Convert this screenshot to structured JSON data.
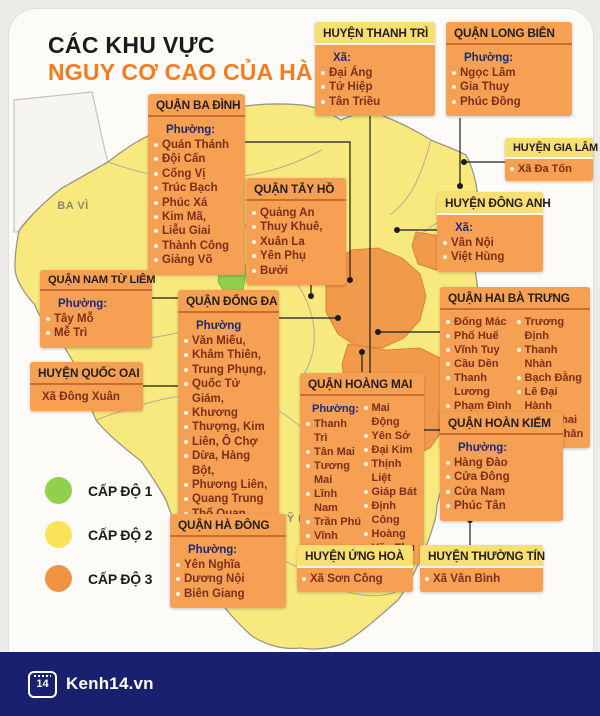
{
  "title": {
    "line1": "CÁC KHU VỰC",
    "line2": "NGUY CƠ CAO CỦA HÀ NỘI"
  },
  "colors": {
    "accent_orange": "#F47B20",
    "box_orange": "#F5A052",
    "header_yellow": "#F8DF72",
    "level1_green": "#8FD04C",
    "level2_yellow": "#F8E97F",
    "level3_orange": "#F19A4B",
    "footer_navy": "#19206E",
    "label_navy": "#1E2A78"
  },
  "legend": [
    {
      "label": "CẤP ĐỘ 1",
      "color": "#8FD04C"
    },
    {
      "label": "CẤP ĐỘ 2",
      "color": "#F8E456"
    },
    {
      "label": "CẤP ĐỘ 3",
      "color": "#F19442"
    }
  ],
  "map_labels": {
    "ba_vi": "BA VÌ",
    "ung_hoa": "ỨNG HÒA",
    "my_duc": "MỸ ĐỨC"
  },
  "boxes": [
    {
      "title": "HUYỆN THANH TRÌ",
      "label": "Xã:",
      "items": [
        "Đại Áng",
        "Tứ Hiệp",
        "Tân Triều"
      ]
    },
    {
      "title": "QUẬN LONG BIÊN",
      "label": "Phường:",
      "items": [
        "Ngọc Lâm",
        "Gia Thuy",
        "Phúc Đồng"
      ]
    },
    {
      "title": "QUẬN BA ĐÌNH",
      "label": "Phường:",
      "items": [
        "Quán Thánh",
        "Đội Cấn",
        "Cống Vị",
        "Trúc Bạch",
        "Phúc Xá",
        "Kim Mã,",
        "Liễu Giai",
        "Thành Công",
        "Giảng Võ"
      ]
    },
    {
      "title": "QUẬN TÂY HỒ",
      "label": "",
      "items": [
        "Quảng An",
        "Thuy Khuê,",
        "Xuân La",
        "Yên Phụ",
        "Bưởi"
      ]
    },
    {
      "title": "HUYỆN GIA LÂM",
      "label": "",
      "items": [
        "Xã Đa Tốn"
      ]
    },
    {
      "title": "HUYỆN ĐÔNG ANH",
      "label": "Xã:",
      "items": [
        "Vân Nội",
        "Việt Hùng"
      ]
    },
    {
      "title": "QUẬN NAM TỪ LIÊM",
      "label": "Phường:",
      "items": [
        "Tây Mỗ",
        "Mễ Trì"
      ]
    },
    {
      "title": "HUYỆN QUỐC OAI",
      "label": "",
      "items": [
        "Xã Đông Xuân"
      ]
    },
    {
      "title": "QUẬN ĐỐNG ĐA",
      "label": "Phường",
      "items": [
        "Văn Miếu,",
        "Khâm Thiên,",
        "Trung Phụng,",
        "Quốc Tử Giám,",
        "Khương",
        "Thượng, Kim",
        "Liên, Ô Chợ",
        "Dừa, Hàng Bột,",
        "Phương Liên,",
        "Quang Trung",
        "Thổ Quan"
      ]
    },
    {
      "title": "QUẬN HAI BÀ TRƯNG",
      "label": "",
      "items_left": [
        "Đống Mác",
        "Phố Huế",
        "Vĩnh Tuy",
        "Cầu Dền",
        "Thanh Lương",
        "Phạm Đình Hổ"
      ],
      "items_right": [
        "Trương Định",
        "Thanh Nhàn",
        "Bạch Đằng",
        "Lê Đại Hành",
        "Minh Khai",
        "Đồng Nhân"
      ]
    },
    {
      "title": "QUẬN HOÀNG MAI",
      "label": "Phường:",
      "items_left": [
        "Thanh Trì",
        "Tân Mai",
        "Tương Mai",
        "Lĩnh Nam",
        "Trần Phú",
        "Vĩnh Hưng"
      ],
      "items_right": [
        "Mai Động",
        "Yên Sở",
        "Đại Kim",
        "Thịnh Liệt",
        "Giáp Bát",
        "Định Công",
        "Hoàng Văn Thụ"
      ]
    },
    {
      "title": "QUẬN HOÀN KIẾM",
      "label": "Phường:",
      "items": [
        "Hàng Đào",
        "Cửa Đông",
        "Cửa Nam",
        "Phúc Tân"
      ]
    },
    {
      "title": "QUẬN HÀ ĐÔNG",
      "label": "Phường:",
      "items": [
        "Yên Nghĩa",
        "Dương Nội",
        "Biên Giang"
      ]
    },
    {
      "title": "HUYỆN ỨNG HOÀ",
      "label": "",
      "items": [
        "Xã Sơn Công"
      ]
    },
    {
      "title": "HUYỆN THƯỜNG TÍN",
      "label": "",
      "items": [
        "Xã Vân Bình"
      ]
    }
  ],
  "footer": {
    "logo_icon": "14",
    "logo_text": "Kenh14.vn"
  }
}
